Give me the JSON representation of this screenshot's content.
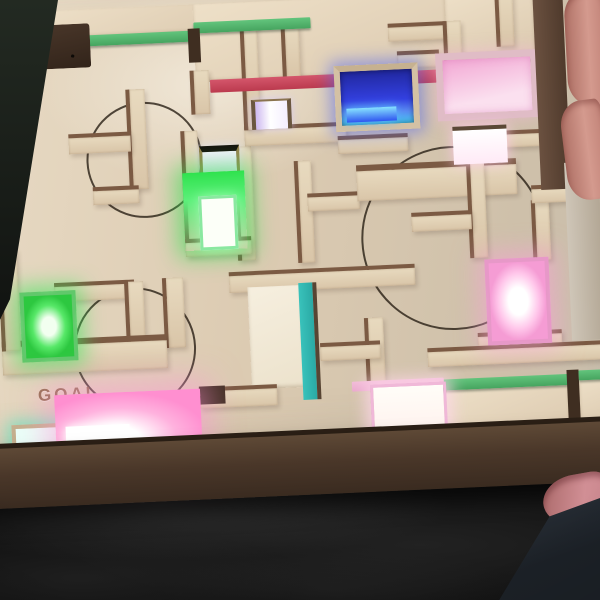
{
  "scene": {
    "type": "photograph",
    "subject": "hand-held wooden labyrinth maze game board with glowing color LED windows over dark fabric",
    "engraved_circle_count": 3
  },
  "board": {
    "goal_label": "GOAL"
  },
  "leds": [
    {
      "name": "green-center",
      "color": "#2fe24e"
    },
    {
      "name": "white-framed-window",
      "color": "#f1ecfc"
    },
    {
      "name": "lavender-window",
      "color": "#e9ddf8"
    },
    {
      "name": "blue-top",
      "color": "#3340e0"
    },
    {
      "name": "pink-top-right",
      "color": "#f2a8d4"
    },
    {
      "name": "pink-right",
      "color": "#ffc6ea"
    },
    {
      "name": "green-left",
      "color": "#2dc840"
    },
    {
      "name": "teal-bottom-left",
      "color": "#49e8c2"
    },
    {
      "name": "pink-bottom-left",
      "color": "#ffb2de"
    },
    {
      "name": "white-bottom-center",
      "color": "#fff6ee"
    }
  ],
  "colors": {
    "floor": "#dccbb2",
    "floor_light": "#e9dcc6",
    "wall_face": "#d9c5a8",
    "wall_face_light": "#e8dabf",
    "wall_edge": "#7b5a43",
    "box_side": "#5e4936",
    "box_side_dark": "#3a2b20",
    "fabric": "#121212",
    "goal_text": "#8a6444",
    "edge_green": "#46a45f",
    "edge_red": "#bb3a4e",
    "edge_teal": "#2aa9a4",
    "edge_pink": "#e9a8cc"
  }
}
